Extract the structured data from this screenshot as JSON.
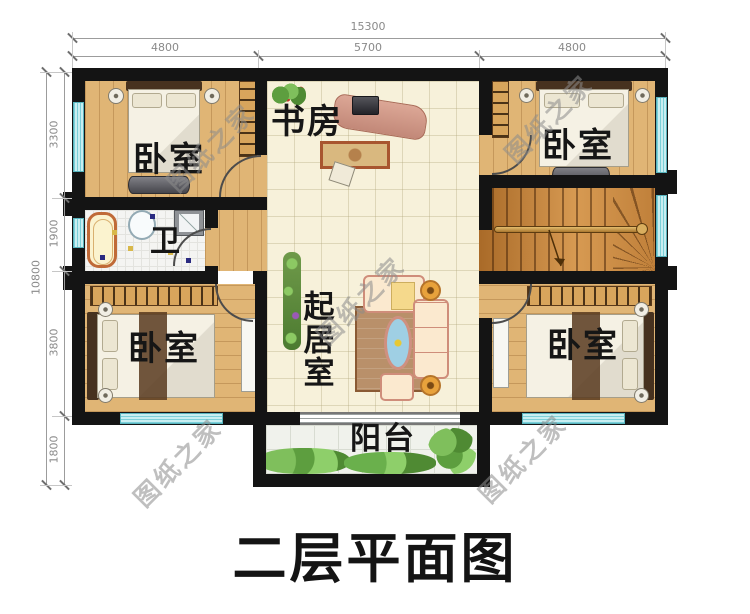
{
  "title": "二层平面图",
  "watermark": "图纸之家",
  "dimensions": {
    "top": {
      "total": "15300",
      "segments": [
        "4800",
        "5700",
        "4800"
      ]
    },
    "left": {
      "total": "10800",
      "segments": [
        "3300",
        "1900",
        "3800",
        "1800"
      ]
    }
  },
  "rooms": {
    "bedroom_top_left": "卧室",
    "study": "书房",
    "bedroom_top_right": "卧室",
    "bathroom": "卫",
    "living_room": "起居室",
    "bedroom_bottom_left": "卧室",
    "bedroom_bottom_right": "卧室",
    "balcony": "阳台"
  },
  "colors": {
    "wall": "#141414",
    "wood-floor": "#e0b575",
    "tile-floor": "#f7f1da",
    "window-glass": "#c9eef1",
    "window-stripe": "#7bd0d9",
    "stair-wood": "#c9813b",
    "label-text": "#161616",
    "dimension-text": "#8a8a8a",
    "watermark-gray": "#8c8c8c"
  }
}
